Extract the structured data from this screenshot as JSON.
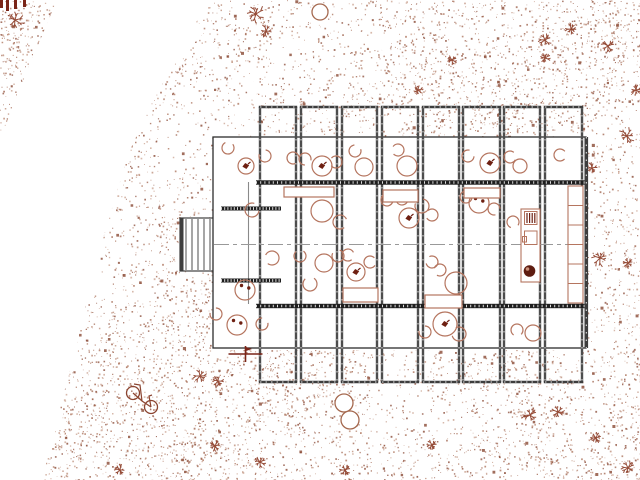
{
  "canvas": {
    "width": 640,
    "height": 480,
    "background": "#ffffff"
  },
  "palette": {
    "stipple_colors": [
      "#c9a28f",
      "#b98a74",
      "#aa6f57",
      "#9c5f48",
      "#8a4a35"
    ],
    "stipple_dark": "#8a4a35",
    "plant": "#8b3a24",
    "furniture": "#b5755f",
    "furniture_dark": "#6e2012",
    "wall": "#4d4d4d",
    "wall_cap": "#3d3d3d",
    "wall_heavy": "#1e1e1e",
    "envelope": "#2d2d2d",
    "partition": "#8a8a8a",
    "centerline": "#999999",
    "marker": "#7a2518",
    "tree": "#a5694f",
    "bicycle": "#8b4430",
    "white": "#ffffff"
  },
  "terrain": {
    "seed": 1337,
    "dot_candidates": 22000,
    "blob_count": 300,
    "clearing_polygon": [
      [
        57,
        0
      ],
      [
        213,
        0
      ],
      [
        196,
        22
      ],
      [
        203,
        34
      ],
      [
        178,
        60
      ],
      [
        166,
        78
      ],
      [
        152,
        102
      ],
      [
        143,
        122
      ],
      [
        130,
        150
      ],
      [
        122,
        175
      ],
      [
        113,
        205
      ],
      [
        104,
        235
      ],
      [
        98,
        262
      ],
      [
        88,
        295
      ],
      [
        82,
        322
      ],
      [
        75,
        352
      ],
      [
        62,
        400
      ],
      [
        52,
        440
      ],
      [
        42,
        480
      ],
      [
        0,
        480
      ],
      [
        0,
        137
      ],
      [
        2,
        135
      ],
      [
        20,
        88
      ],
      [
        38,
        45
      ]
    ],
    "building_hole": {
      "x": 213,
      "y": 137,
      "w": 373,
      "h": 213
    },
    "white_spots": [
      {
        "cx": 355,
        "cy": 38,
        "r": 7
      },
      {
        "cx": 385,
        "cy": 45,
        "r": 6
      },
      {
        "cx": 253,
        "cy": 88,
        "r": 7
      },
      {
        "cx": 303,
        "cy": 85,
        "r": 6
      },
      {
        "cx": 452,
        "cy": 33,
        "r": 5
      }
    ],
    "plants": [
      {
        "x": 15,
        "y": 20,
        "s": 11
      },
      {
        "x": 48,
        "y": 73,
        "s": 9
      },
      {
        "x": 34,
        "y": 94,
        "s": 8
      },
      {
        "x": 63,
        "y": 87,
        "s": 7
      },
      {
        "x": 6,
        "y": 203,
        "s": 6
      },
      {
        "x": 256,
        "y": 14,
        "s": 11
      },
      {
        "x": 266,
        "y": 31,
        "s": 7
      },
      {
        "x": 545,
        "y": 40,
        "s": 8
      },
      {
        "x": 571,
        "y": 29,
        "s": 6
      },
      {
        "x": 608,
        "y": 46,
        "s": 7
      },
      {
        "x": 545,
        "y": 58,
        "s": 6
      },
      {
        "x": 627,
        "y": 136,
        "s": 9
      },
      {
        "x": 592,
        "y": 168,
        "s": 6
      },
      {
        "x": 636,
        "y": 90,
        "s": 6
      },
      {
        "x": 600,
        "y": 258,
        "s": 9
      },
      {
        "x": 628,
        "y": 263,
        "s": 6
      },
      {
        "x": 571,
        "y": 300,
        "s": 6
      },
      {
        "x": 68,
        "y": 288,
        "s": 9
      },
      {
        "x": 80,
        "y": 301,
        "s": 7
      },
      {
        "x": 57,
        "y": 277,
        "s": 6
      },
      {
        "x": 200,
        "y": 376,
        "s": 7
      },
      {
        "x": 218,
        "y": 381,
        "s": 6
      },
      {
        "x": 530,
        "y": 415,
        "s": 10
      },
      {
        "x": 558,
        "y": 412,
        "s": 8
      },
      {
        "x": 628,
        "y": 468,
        "s": 8
      },
      {
        "x": 596,
        "y": 438,
        "s": 6
      },
      {
        "x": 345,
        "y": 470,
        "s": 7
      },
      {
        "x": 215,
        "y": 446,
        "s": 6
      },
      {
        "x": 260,
        "y": 462,
        "s": 6
      },
      {
        "x": 120,
        "y": 470,
        "s": 6
      },
      {
        "x": 432,
        "y": 445,
        "s": 6
      },
      {
        "x": 418,
        "y": 90,
        "s": 5
      },
      {
        "x": 452,
        "y": 60,
        "s": 5
      }
    ],
    "corner_bars": [
      {
        "x": 0,
        "y": 0,
        "w": 3,
        "h": 8
      },
      {
        "x": 6,
        "y": 0,
        "w": 3,
        "h": 11
      },
      {
        "x": 14,
        "y": 0,
        "w": 3,
        "h": 9
      },
      {
        "x": 23,
        "y": 0,
        "w": 3,
        "h": 7
      }
    ]
  },
  "building": {
    "envelope": {
      "x": 213,
      "y": 137,
      "w": 373,
      "h": 211
    },
    "bay_top_y": 107,
    "bay_bottom_y": 382,
    "bays": [
      [
        260,
        296
      ],
      [
        301,
        337
      ],
      [
        342,
        377
      ],
      [
        382,
        418
      ],
      [
        423,
        459
      ],
      [
        463,
        500
      ],
      [
        504,
        540
      ],
      [
        545,
        582
      ]
    ],
    "heavy_walls": [
      {
        "x1": 256,
        "x2": 585,
        "y": 182.5
      },
      {
        "x1": 256,
        "x2": 585,
        "y": 306
      }
    ],
    "hatched_walls": [
      {
        "x1": 221,
        "x2": 281,
        "y": 208.5
      },
      {
        "x1": 221,
        "x2": 281,
        "y": 280.5
      }
    ],
    "partition": {
      "x": 248.5,
      "y1": 182,
      "y2": 304
    },
    "right_wall": {
      "x": 586.3,
      "y1": 137,
      "y2": 348
    },
    "centerline": {
      "x1": 214,
      "x2": 584,
      "y": 244.5
    },
    "dock": {
      "x": 180,
      "y": 218,
      "w": 34,
      "h": 53,
      "plank_step": 6
    }
  },
  "furniture": {
    "round_tables": [
      {
        "cx": 246,
        "cy": 166,
        "r": 8,
        "g": "bird"
      },
      {
        "cx": 322,
        "cy": 166,
        "r": 10,
        "g": "bird"
      },
      {
        "cx": 364,
        "cy": 167,
        "r": 9
      },
      {
        "cx": 407,
        "cy": 166,
        "r": 10
      },
      {
        "cx": 490,
        "cy": 163,
        "r": 10,
        "g": "bird"
      },
      {
        "cx": 520,
        "cy": 166,
        "r": 7
      },
      {
        "cx": 409,
        "cy": 218,
        "r": 10,
        "g": "bird"
      },
      {
        "cx": 479,
        "cy": 203,
        "r": 10,
        "g": "dots"
      },
      {
        "cx": 322,
        "cy": 211,
        "r": 11
      },
      {
        "cx": 324,
        "cy": 263,
        "r": 9
      },
      {
        "cx": 356,
        "cy": 272,
        "r": 9,
        "g": "bird"
      },
      {
        "cx": 245,
        "cy": 290,
        "r": 10,
        "g": "dots"
      },
      {
        "cx": 456,
        "cy": 283,
        "r": 11
      },
      {
        "cx": 237,
        "cy": 325,
        "r": 10,
        "g": "dots"
      },
      {
        "cx": 445,
        "cy": 324,
        "r": 12,
        "g": "bird"
      },
      {
        "cx": 533,
        "cy": 333,
        "r": 8
      }
    ],
    "chairs": [
      {
        "cx": 228,
        "cy": 148,
        "r": 6
      },
      {
        "cx": 265,
        "cy": 156,
        "r": 6
      },
      {
        "cx": 293,
        "cy": 158,
        "r": 6
      },
      {
        "cx": 305,
        "cy": 159,
        "r": 6
      },
      {
        "cx": 336,
        "cy": 162,
        "r": 6
      },
      {
        "cx": 355,
        "cy": 151,
        "r": 6
      },
      {
        "cx": 398,
        "cy": 150,
        "r": 6
      },
      {
        "cx": 468,
        "cy": 156,
        "r": 6
      },
      {
        "cx": 510,
        "cy": 157,
        "r": 6
      },
      {
        "cx": 560,
        "cy": 155,
        "r": 6
      },
      {
        "cx": 252,
        "cy": 210,
        "r": 7
      },
      {
        "cx": 340,
        "cy": 222,
        "r": 7
      },
      {
        "cx": 387,
        "cy": 200,
        "r": 6
      },
      {
        "cx": 402,
        "cy": 199,
        "r": 6
      },
      {
        "cx": 422,
        "cy": 206,
        "r": 7
      },
      {
        "cx": 432,
        "cy": 215,
        "r": 6
      },
      {
        "cx": 466,
        "cy": 197,
        "r": 6
      },
      {
        "cx": 494,
        "cy": 209,
        "r": 6
      },
      {
        "cx": 513,
        "cy": 222,
        "r": 6
      },
      {
        "cx": 272,
        "cy": 258,
        "r": 7
      },
      {
        "cx": 300,
        "cy": 256,
        "r": 6
      },
      {
        "cx": 338,
        "cy": 256,
        "r": 6
      },
      {
        "cx": 348,
        "cy": 255,
        "r": 6
      },
      {
        "cx": 370,
        "cy": 262,
        "r": 6
      },
      {
        "cx": 310,
        "cy": 284,
        "r": 7
      },
      {
        "cx": 440,
        "cy": 270,
        "r": 6
      },
      {
        "cx": 432,
        "cy": 262,
        "r": 6
      },
      {
        "cx": 216,
        "cy": 314,
        "r": 6
      },
      {
        "cx": 262,
        "cy": 324,
        "r": 6
      },
      {
        "cx": 425,
        "cy": 332,
        "r": 6
      },
      {
        "cx": 459,
        "cy": 334,
        "r": 7
      },
      {
        "cx": 517,
        "cy": 330,
        "r": 6
      }
    ],
    "rect_tables": [
      {
        "x": 284,
        "y": 187,
        "w": 50,
        "h": 10
      },
      {
        "x": 383,
        "y": 190,
        "w": 35,
        "h": 12
      },
      {
        "x": 464,
        "y": 188,
        "w": 36,
        "h": 10
      },
      {
        "x": 343,
        "y": 288,
        "w": 35,
        "h": 14
      },
      {
        "x": 425,
        "y": 295,
        "w": 37,
        "h": 13
      }
    ],
    "shelving": {
      "x": 568,
      "y": 186,
      "w": 15,
      "rows": 6,
      "row_h": 19.5
    },
    "kitchen": {
      "x": 521,
      "y": 209,
      "w": 19,
      "h": 73
    },
    "trees": [
      {
        "cx": 320,
        "cy": 12,
        "r": 8
      },
      {
        "cx": 344,
        "cy": 403,
        "r": 9
      },
      {
        "cx": 350,
        "cy": 420,
        "r": 9
      }
    ],
    "bicycle": {
      "w1x": 133,
      "w1y": 393,
      "w2x": 151,
      "w2y": 407,
      "r": 6.5
    },
    "survey_marker": {
      "x": 245.5,
      "y": 354
    }
  }
}
